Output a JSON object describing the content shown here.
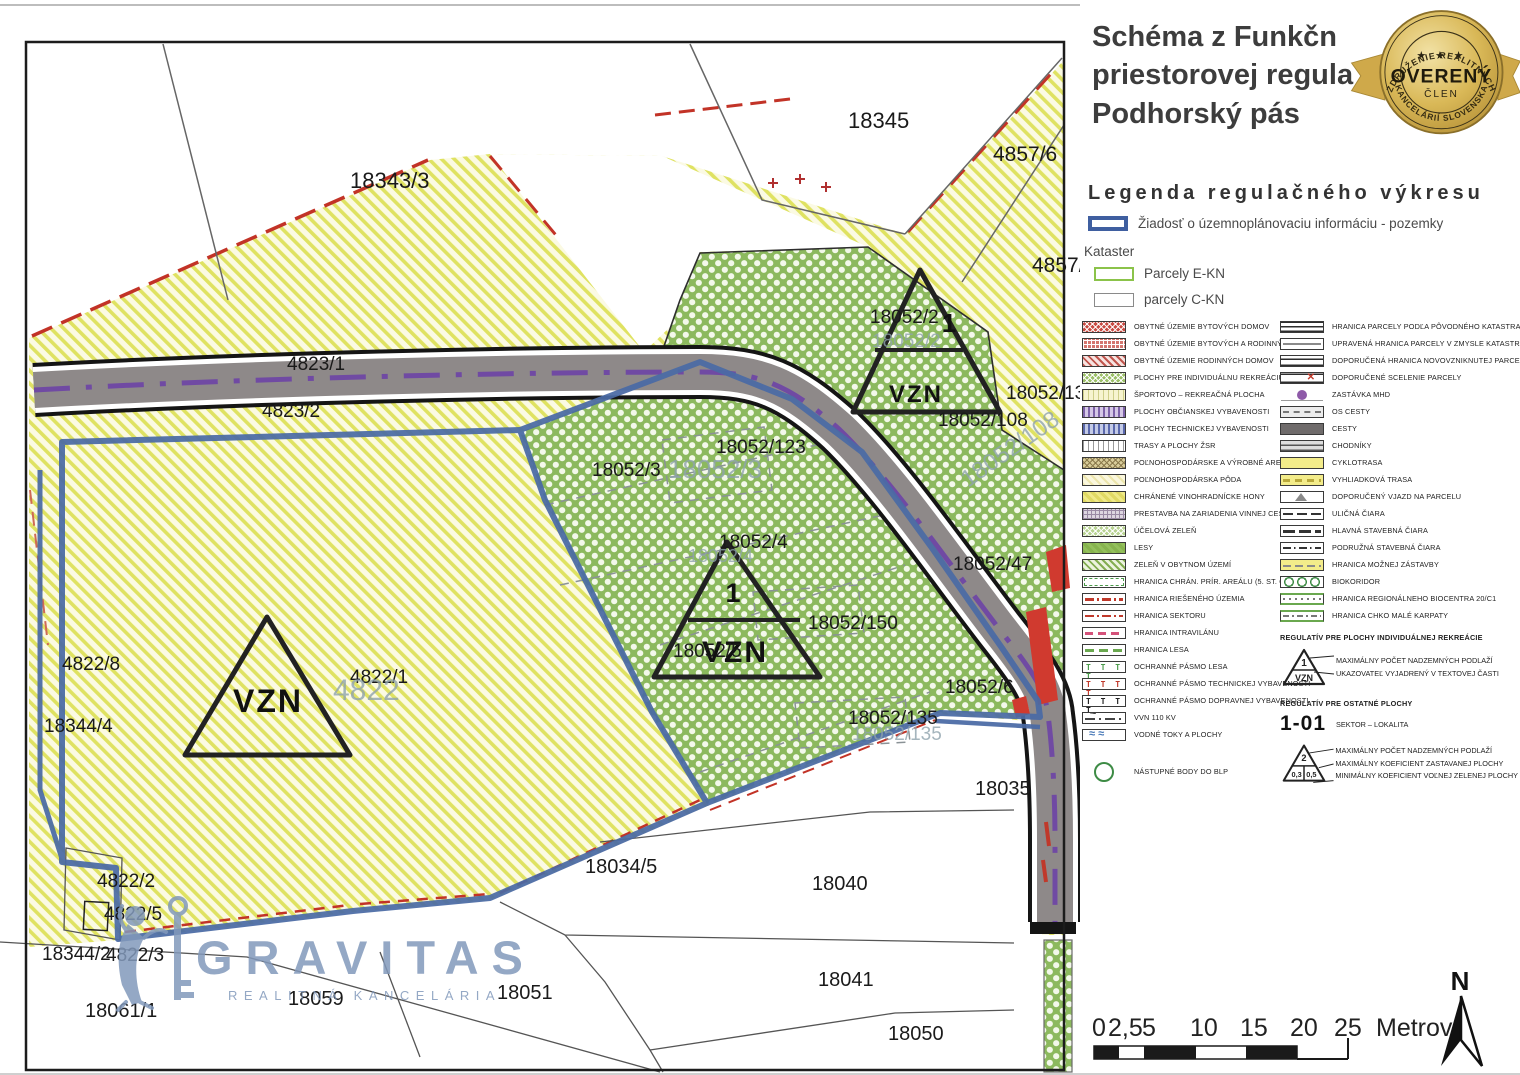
{
  "panel": {
    "title_lines": [
      "Schéma z Funkčn",
      "priestorovej regula",
      "Podhorský pás"
    ],
    "badge": {
      "arc_top": "ZDRUŽENIE REALITNÝCH",
      "arc_bottom": "KANCELÁRIÍ SLOVENSKA",
      "stars": "★ ★ ★",
      "main": "OVERENÝ",
      "sub": "ČLEN",
      "gold": "#d9b857"
    },
    "legend_title": "Legenda regulačného výkresu",
    "request_item": {
      "label": "Žiadosť o územnoplánovaciu informáciu - pozemky",
      "color": "#3f5fa0"
    },
    "kataster_label": "Kataster",
    "kataster_items": [
      {
        "label": "Parcely E-KN",
        "color": "#8bc34a"
      },
      {
        "label": "parcely C-KN",
        "color": "#8a8a8a"
      }
    ],
    "legend_left": [
      {
        "label": "OBYTNÉ ÚZEMIE BYTOVÝCH DOMOV",
        "swatch": "red-cross"
      },
      {
        "label": "OBYTNÉ ÚZEMIE BYTOVÝCH A RODINNÝCH DOMOV",
        "swatch": "red-dot"
      },
      {
        "label": "OBYTNÉ ÚZEMIE RODINNÝCH DOMOV",
        "swatch": "red-diag"
      },
      {
        "label": "PLOCHY PRE INDIVIDUÁLNU REKREÁCIU",
        "swatch": "green-cross"
      },
      {
        "label": "ŠPORTOVO – REKREAČNÁ PLOCHA",
        "swatch": "yellow-v"
      },
      {
        "label": "PLOCHY OBČIANSKEJ VYBAVENOSTI",
        "swatch": "purple-v"
      },
      {
        "label": "PLOCHY TECHNICKEJ VYBAVENOSTI",
        "swatch": "blue-v"
      },
      {
        "label": "TRASY A PLOCHY ŽSR",
        "swatch": "white-v"
      },
      {
        "label": "POĽNOHOSPODÁRSKE A VÝROBNÉ AREÁLY",
        "swatch": "khaki-cross"
      },
      {
        "label": "POĽNOHOSPODÁRSKA PÔDA",
        "swatch": "pale-yellow"
      },
      {
        "label": "CHRÁNENÉ VINOHRADNÍCKE HONY",
        "swatch": "yellow"
      },
      {
        "label": "PRESTAVBA NA ZARIADENIA VINNEJ CESTY",
        "swatch": "grid-purple"
      },
      {
        "label": "ÚČELOVÁ ZELEŇ",
        "swatch": "green-dot"
      },
      {
        "label": "LESY",
        "swatch": "green"
      },
      {
        "label": "ZELEŇ V OBYTNOM ÚZEMÍ",
        "swatch": "green-diag"
      },
      {
        "label": "HRANICA CHRÁN. PRÍR. AREÁLU (5. ST. OCHR.)",
        "swatch": "border-green-dash"
      },
      {
        "label": "HRANICA RIEŠENÉHO ÚZEMIA",
        "swatch": "ln-red-dashdot"
      },
      {
        "label": "HRANICA SEKTORU",
        "swatch": "ln-red-dashdot-thin"
      },
      {
        "label": "HRANICA INTRAVILÁNU",
        "swatch": "ln-pink-dash"
      },
      {
        "label": "HRANICA LESA",
        "swatch": "ln-green-dash"
      },
      {
        "label": "OCHRANNÉ PÁSMO LESA",
        "swatch": "t-green"
      },
      {
        "label": "OCHRANNÉ PÁSMO TECHNICKEJ VYBAVENOSTI",
        "swatch": "t-red"
      },
      {
        "label": "OCHRANNÉ PÁSMO DOPRAVNEJ VYBAVENOSTI",
        "swatch": "t-black"
      },
      {
        "label": "VVN 110 KV",
        "swatch": "vvn"
      },
      {
        "label": "VODNÉ TOKY A PLOCHY",
        "swatch": "water"
      },
      {
        "label": "NÁSTUPNÉ BODY DO BLP",
        "swatch": "circle-green",
        "gap_before": 20
      }
    ],
    "legend_right": [
      {
        "label": "HRANICA PARCELY PODĽA PÔVODNÉHO KATASTRA",
        "swatch": "dbl-black"
      },
      {
        "label": "UPRAVENÁ HRANICA PARCELY V ZMYSLE KATASTRA",
        "swatch": "ln-gray"
      },
      {
        "label": "DOPORUČENÁ HRANICA NOVOVZNIKNUTEJ PARCELY",
        "swatch": "dbl-black2"
      },
      {
        "label": "DOPORUČENÉ SCELENIE PARCELY",
        "swatch": "scelenie"
      },
      {
        "label": "ZASTÁVKA MHD",
        "swatch": "mhd"
      },
      {
        "label": "OS CESTY",
        "swatch": "os-cesty"
      },
      {
        "label": "CESTY",
        "swatch": "cesty"
      },
      {
        "label": "CHODNÍKY",
        "swatch": "chodniky"
      },
      {
        "label": "CYKLOTRASA",
        "swatch": "cyklo"
      },
      {
        "label": "VYHLIADKOVÁ TRASA",
        "swatch": "vyhliadka"
      },
      {
        "label": "DOPORUČENÝ VJAZD NA PARCELU",
        "swatch": "vjazd"
      },
      {
        "label": "ULIČNÁ ČIARA",
        "swatch": "ulicna"
      },
      {
        "label": "HLAVNÁ STAVEBNÁ ČIARA",
        "swatch": "hlavna"
      },
      {
        "label": "PODRUŽNÁ STAVEBNÁ ČIARA",
        "swatch": "podruzna"
      },
      {
        "label": "HRANICA MOŽNEJ ZÁSTAVBY",
        "swatch": "zastavba"
      },
      {
        "label": "BIOKORIDOR",
        "swatch": "biokoridor"
      },
      {
        "label": "HRANICA REGIONÁLNEHO BIOCENTRA 20/C1",
        "swatch": "biocentrum"
      },
      {
        "label": "HRANICA CHKO MALÉ KARPATY",
        "swatch": "chko"
      }
    ],
    "reg_individual": {
      "title": "REGULATÍV PRE PLOCHY INDIVIDUÁLNEJ REKREÁCIE",
      "tri_top": "1",
      "tri_bottom": "VZN",
      "lines": [
        "MAXIMÁLNY POČET NADZEMNÝCH PODLAŽÍ",
        "UKAZOVATEĽ VYJADRENÝ V TEXTOVEJ ČASTI"
      ]
    },
    "reg_other": {
      "title": "REGULATÍV PRE OSTATNÉ PLOCHY",
      "sektor_code": "1-01",
      "sektor_label": "SEKTOR – LOKALITA",
      "tri_top": "2",
      "tri_b1": "0,3",
      "tri_b2": "0,5",
      "lines": [
        "MAXIMÁLNY POČET NADZEMNÝCH PODLAŽÍ",
        "MAXIMÁLNY KOEFICIENT ZASTAVANEJ PLOCHY",
        "MINIMÁLNY KOEFICIENT VOĽNEJ ZELENEJ PLOCHY"
      ]
    },
    "scale": {
      "ticks": [
        "0",
        "2,5",
        "5",
        "10",
        "15",
        "20",
        "25"
      ],
      "unit": "Metrov"
    },
    "north_label": "N"
  },
  "map": {
    "watermark": {
      "text": "GRAVITAS",
      "subtext": "REALITNÁ KANCELÁRIA",
      "color": "#8299bb"
    },
    "colors": {
      "request_blue": "#4a6aa5",
      "road_gray": "#8e8989",
      "cyclo_purple": "#6b3fa8",
      "red_zone": "#d03a2f"
    },
    "parcels": [
      {
        "t": "18343/3",
        "x": 350,
        "y": 188,
        "fs": 22
      },
      {
        "t": "18345",
        "x": 848,
        "y": 128,
        "fs": 22
      },
      {
        "t": "4857/6",
        "x": 993,
        "y": 161,
        "fs": 21
      },
      {
        "t": "4857/2",
        "x": 1032,
        "y": 272,
        "fs": 21
      },
      {
        "t": "18052/2",
        "x": 870,
        "y": 323,
        "fs": 19
      },
      {
        "t": "18052/139",
        "x": 1006,
        "y": 399,
        "fs": 19
      },
      {
        "t": "18052/108",
        "x": 938,
        "y": 426,
        "fs": 19
      },
      {
        "t": "4823/1",
        "x": 287,
        "y": 370,
        "fs": 19
      },
      {
        "t": "4823/2",
        "x": 262,
        "y": 417,
        "fs": 19
      },
      {
        "t": "18052/3",
        "x": 592,
        "y": 476,
        "fs": 19
      },
      {
        "t": "18052/123",
        "x": 716,
        "y": 453,
        "fs": 19
      },
      {
        "t": "18052/4",
        "x": 719,
        "y": 548,
        "fs": 19
      },
      {
        "t": "18052/150",
        "x": 808,
        "y": 629,
        "fs": 19
      },
      {
        "t": "18052/5",
        "x": 673,
        "y": 657,
        "fs": 19
      },
      {
        "t": "18052/47",
        "x": 953,
        "y": 570,
        "fs": 19
      },
      {
        "t": "18052/6",
        "x": 945,
        "y": 693,
        "fs": 19
      },
      {
        "t": "18052/135",
        "x": 848,
        "y": 724,
        "fs": 19
      },
      {
        "t": "18035",
        "x": 975,
        "y": 795,
        "fs": 20
      },
      {
        "t": "18034/5",
        "x": 585,
        "y": 873,
        "fs": 20
      },
      {
        "t": "18040",
        "x": 812,
        "y": 890,
        "fs": 20
      },
      {
        "t": "18041",
        "x": 818,
        "y": 986,
        "fs": 20
      },
      {
        "t": "18050",
        "x": 888,
        "y": 1040,
        "fs": 20
      },
      {
        "t": "18059",
        "x": 288,
        "y": 1005,
        "fs": 20
      },
      {
        "t": "18051",
        "x": 497,
        "y": 999,
        "fs": 20
      },
      {
        "t": "18061/1",
        "x": 85,
        "y": 1017,
        "fs": 20
      },
      {
        "t": "18344/2",
        "x": 42,
        "y": 960,
        "fs": 19
      },
      {
        "t": "4822/3",
        "x": 106,
        "y": 961,
        "fs": 19
      },
      {
        "t": "4822/5",
        "x": 104,
        "y": 920,
        "fs": 19
      },
      {
        "t": "4822/2",
        "x": 97,
        "y": 887,
        "fs": 19
      },
      {
        "t": "4822/8",
        "x": 62,
        "y": 670,
        "fs": 19
      },
      {
        "t": "18344/4",
        "x": 44,
        "y": 732,
        "fs": 19
      },
      {
        "t": "4822/1",
        "x": 350,
        "y": 683,
        "fs": 19
      }
    ],
    "faded_labels": [
      {
        "t": "18052/3",
        "x": 668,
        "y": 478,
        "fs": 26
      },
      {
        "t": "18052/2",
        "x": 872,
        "y": 347,
        "fs": 19
      },
      {
        "t": "18052/108",
        "x": 968,
        "y": 488,
        "fs": 24,
        "rot": -35
      },
      {
        "t": "4822",
        "x": 333,
        "y": 700,
        "fs": 30
      },
      {
        "t": "18052/135",
        "x": 852,
        "y": 740,
        "fs": 19
      },
      {
        "t": "18052/4",
        "x": 688,
        "y": 562,
        "fs": 18
      }
    ],
    "vzn_triangles": [
      {
        "path": "M920,270 L1000,412 L853,412 Z",
        "mid": [
          875,
          963,
          350
        ],
        "top": "1",
        "tx": 949,
        "ty": 332,
        "tfs": 26,
        "bottom": "VZN",
        "vx": 916,
        "vy": 402,
        "vfs": 24
      },
      {
        "path": "M727,542 L820,677 L654,677 Z",
        "mid": [
          688,
          800,
          620
        ],
        "top": "1",
        "tx": 733,
        "ty": 602,
        "tfs": 27,
        "bottom": "VZN",
        "vx": 735,
        "vy": 662,
        "vfs": 30
      },
      {
        "path": "M267,617 L350,755 L185,755 Z",
        "mid": null,
        "top": null,
        "bottom": "VZN",
        "vx": 268,
        "vy": 712,
        "vfs": 32
      }
    ]
  }
}
